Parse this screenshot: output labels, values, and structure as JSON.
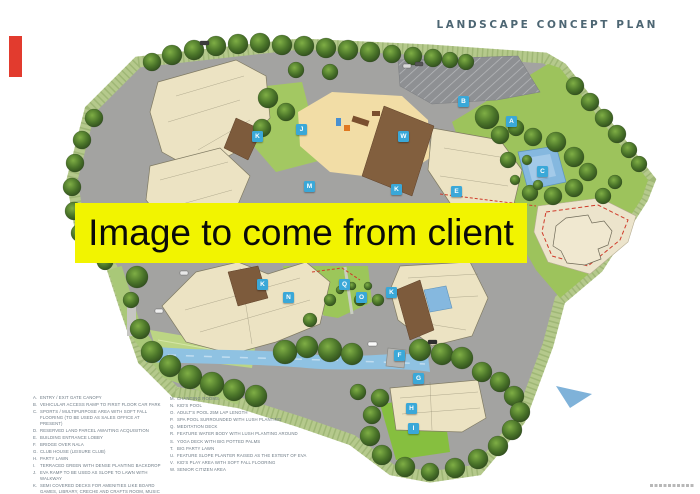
{
  "page": {
    "title": "LANDSCAPE CONCEPT PLAN",
    "banner_text": "Image to come from client"
  },
  "colors": {
    "title_text": "#4d6673",
    "banner_bg": "#f2f400",
    "banner_text": "#0a0a0a",
    "marker_bg": "#3aa8d8",
    "legend_text": "#6d7a85",
    "annotation_red": "#e23b2e",
    "site_green": "#9dc35c",
    "boundary_band_green": "#b5c98c",
    "water_blue": "#85b8df",
    "building_cream": "#ece3c3",
    "roof_brown": "#7d5b3c",
    "road_gray": "#a3a3a1",
    "play_sand": "#f2dda6"
  },
  "legend": {
    "left": [
      {
        "key": "A",
        "text": "ENTRY / EXIT GATE CANOPY"
      },
      {
        "key": "B",
        "text": "VEHICULAR ACCESS RAMP TO FIRST FLOOR CAR PARK"
      },
      {
        "key": "C",
        "text": "SPORTS / MULTIPURPOSE AREA WITH SOFT FALL FLOORING (TO BE USED AS SALES OFFICE AT PRESENT)"
      },
      {
        "key": "D",
        "text": "RESERVED LAND PARCEL AWAITING ACQUISITION"
      },
      {
        "key": "E",
        "text": "BUILDING ENTRANCE LOBBY"
      },
      {
        "key": "F",
        "text": "BRIDGE OVER NALA"
      },
      {
        "key": "G",
        "text": "CLUB HOUSE (LEISURE CLUB)"
      },
      {
        "key": "H",
        "text": "PARTY LAWN"
      },
      {
        "key": "I",
        "text": "TERRACED GREEN WITH DENSE PLANTING BACKDROP"
      },
      {
        "key": "J",
        "text": "EVA RAMP TO BE USED AS SLOPE TO LAWN WITH WALKWAY"
      },
      {
        "key": "K",
        "text": "SEMI COVERED DECKS FOR AMENITIES LIKE BOARD GAMES, LIBRARY, CRECHE AND CRAFTS ROOM, MUSIC ROOM"
      },
      {
        "key": "L",
        "text": "POOL SIDE CAFE SPACE"
      }
    ],
    "right": [
      {
        "key": "M",
        "text": "CHANGING ROOMS"
      },
      {
        "key": "N",
        "text": "KID'S POOL"
      },
      {
        "key": "O",
        "text": "ADULT'S POOL 25M LAP LENGTH"
      },
      {
        "key": "P",
        "text": "SPA POOL SURROUNDED WITH LUSH PLANTING"
      },
      {
        "key": "Q",
        "text": "MEDITATION DECK"
      },
      {
        "key": "R",
        "text": "FEATURE WATER BODY WITH LUSH PLANTING AROUND"
      },
      {
        "key": "S",
        "text": "YOGA DECK WITH BIG POTTED PALMS"
      },
      {
        "key": "T",
        "text": "BIG PARTY LAWN"
      },
      {
        "key": "U",
        "text": "FEATURE SLOPE PLANTER RAISED AS THE EXTENT OF EVA"
      },
      {
        "key": "V",
        "text": "KID'S PLAY AREA WITH SOFT FALL FLOORING"
      },
      {
        "key": "W",
        "text": "SENIOR CITIZEN AREA"
      }
    ]
  },
  "plan": {
    "markers": [
      {
        "letter": "K",
        "x": 258,
        "y": 137
      },
      {
        "letter": "J",
        "x": 302,
        "y": 130
      },
      {
        "letter": "M",
        "x": 310,
        "y": 187
      },
      {
        "letter": "W",
        "x": 404,
        "y": 137
      },
      {
        "letter": "B",
        "x": 464,
        "y": 102
      },
      {
        "letter": "A",
        "x": 512,
        "y": 122
      },
      {
        "letter": "C",
        "x": 543,
        "y": 172
      },
      {
        "letter": "E",
        "x": 457,
        "y": 192
      },
      {
        "letter": "K",
        "x": 397,
        "y": 190
      },
      {
        "letter": "K",
        "x": 263,
        "y": 285
      },
      {
        "letter": "Q",
        "x": 345,
        "y": 285
      },
      {
        "letter": "K",
        "x": 392,
        "y": 293
      },
      {
        "letter": "N",
        "x": 289,
        "y": 298
      },
      {
        "letter": "O",
        "x": 362,
        "y": 298
      },
      {
        "letter": "F",
        "x": 400,
        "y": 356
      },
      {
        "letter": "G",
        "x": 419,
        "y": 379
      },
      {
        "letter": "H",
        "x": 412,
        "y": 409
      },
      {
        "letter": "I",
        "x": 414,
        "y": 429
      }
    ]
  }
}
